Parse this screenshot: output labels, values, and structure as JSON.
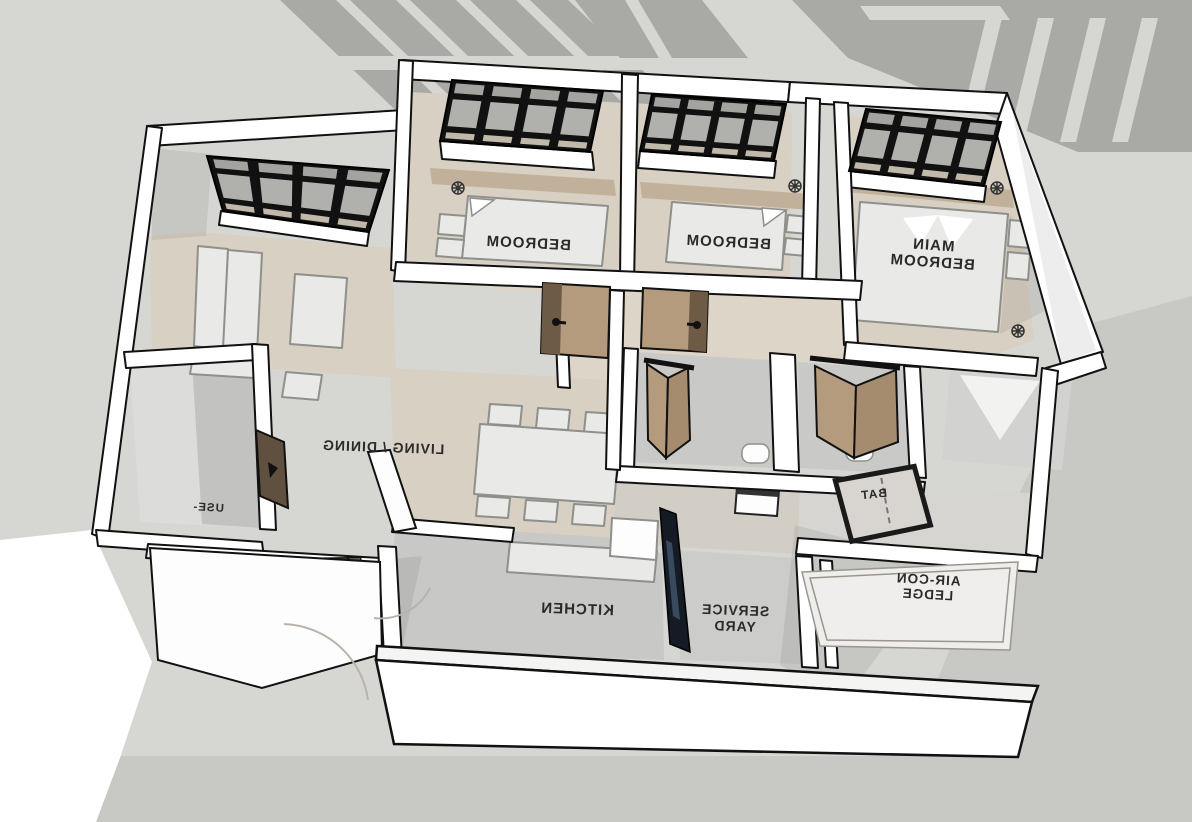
{
  "title": "3D Floor Plan Perspective View",
  "view": {
    "projection": "overhead-rear perspective",
    "labels_mirrored": true
  },
  "rooms": [
    {
      "id": "bedroom-1",
      "label": "BEDROOM"
    },
    {
      "id": "bedroom-2",
      "label": "BEDROOM"
    },
    {
      "id": "main-bedroom",
      "label": "MAIN BEDROOM",
      "line1": "MAIN",
      "line2": "BEDROOM"
    },
    {
      "id": "living-dining",
      "label": "LIVING / DINING"
    },
    {
      "id": "kitchen",
      "label": "KITCHEN"
    },
    {
      "id": "service-yard",
      "label": "SERVICE YARD",
      "line1": "SERVICE",
      "line2": "YARD"
    },
    {
      "id": "aircon-ledge",
      "label": "AIR-CON LEDGE",
      "line1": "AIR-CON",
      "line2": "LEDGE"
    },
    {
      "id": "bathroom",
      "label": "BAT",
      "note": "label partially hidden"
    },
    {
      "id": "household-shelter",
      "label": "USE-",
      "note": "label partially hidden"
    }
  ],
  "colors": {
    "background": "#d6d6d2",
    "cast_shadow": "#a9a9a5",
    "ground_shadow": "#c8c8c4",
    "foreground_white": "#ffffff",
    "wall": "#ffffff",
    "outline": "#111111",
    "floor_wood": "#d8d0c2",
    "floor_tile_gray": "#c8c8c6",
    "headboard_tan": "#c2b19a",
    "door_wood": "#b59b7e",
    "door_wood_dark": "#6e5b45",
    "window_frame": "#111111",
    "window_glass": "#b0b0ac",
    "window_glass_warm": "#c0b8a8",
    "furniture": "#e9e9e7",
    "furniture_outline": "#8f8f8b",
    "glass_panel_dark": "#141b24",
    "label_text": "#2a2a2a"
  }
}
